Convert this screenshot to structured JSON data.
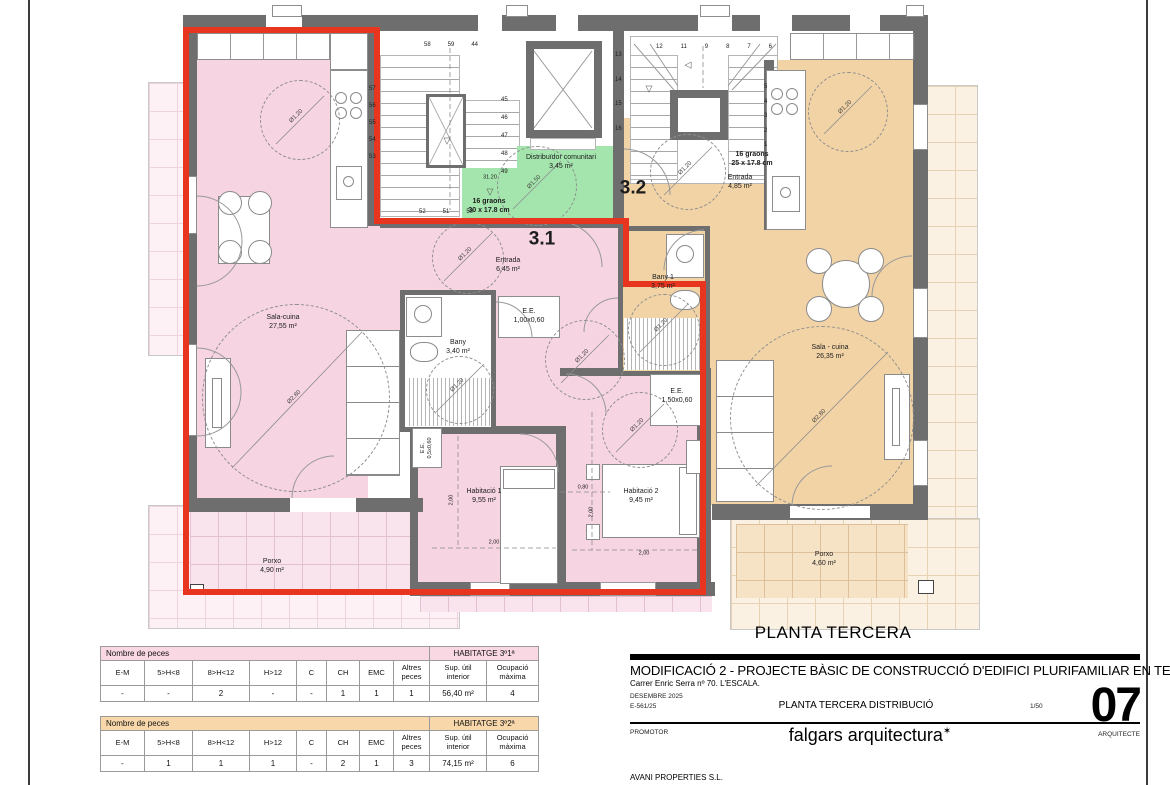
{
  "plan": {
    "heading": "PLANTA TERCERA",
    "unit31": "3.1",
    "unit32": "3.2",
    "icons": {
      "level_marker_down": "▽",
      "level_marker_left": "◁"
    },
    "labels": {
      "sala31": "Sala-cuina\n27,55 m²",
      "entrada31": "Entrada\n6,45 m²",
      "bany31": "Bany\n3,40 m²",
      "ee100": "E.E.\n1,00x0,60",
      "ee050": "E.E.\n0,5x0,60",
      "ee150": "E.E.\n1,50x0,60",
      "hab1": "Habitació 1\n9,55 m²",
      "hab2": "Habitació 2\n9,45 m²",
      "porxo31": "Porxo\n4,90 m²",
      "distribuidor": "Distribuïdor comunitari\n3,45 m²",
      "graons_left": "16 graons\n30 x 17.8 cm",
      "level": "31.20",
      "entrada32": "Entrada\n4,85 m²",
      "graons_right": "16 graons\n25 x 17.8 cm",
      "bany32": "Bany 1\n3,75 m²",
      "sala32": "Sala - cuina\n26,35 m²",
      "porxo32": "Porxo\n4,60 m²"
    },
    "dims": {
      "d120": "Ø1.20",
      "d150": "Ø1.50",
      "d280": "Ø2.80",
      "len200": "2,00",
      "len080": "0,80"
    },
    "stairs_left": {
      "top": [
        "58",
        "59",
        "44"
      ],
      "left_col": [
        "57",
        "56",
        "55",
        "54",
        "53"
      ],
      "right_col": [
        "45",
        "46",
        "47",
        "48",
        "49"
      ],
      "bottom": [
        "52",
        "51",
        "50"
      ]
    },
    "stairs_right": {
      "top": [
        "12",
        "11",
        "9",
        "8",
        "7",
        "6"
      ],
      "left_col": [
        "13",
        "14",
        "15",
        "16"
      ],
      "right_col": [
        "5",
        "4",
        "3",
        "2",
        "1"
      ]
    }
  },
  "tables": [
    {
      "section_label": "Nombre de peces",
      "habitatge_label": "HABITATGE 3º1ª",
      "columns": [
        "E-M",
        "5>H<8",
        "8>H<12",
        "H>12",
        "C",
        "CH",
        "EMC",
        "Altres\npeces",
        "Sup. útil\ninterior",
        "Ocupació\nmàxima"
      ],
      "values": [
        "-",
        "-",
        "2",
        "-",
        "-",
        "1",
        "1",
        "1",
        "56,40 m²",
        "4"
      ]
    },
    {
      "section_label": "Nombre de peces",
      "habitatge_label": "HABITATGE 3º2ª",
      "columns": [
        "E-M",
        "5>H<8",
        "8>H<12",
        "H>12",
        "C",
        "CH",
        "EMC",
        "Altres\npeces",
        "Sup. útil\ninterior",
        "Ocupació\nmàxima"
      ],
      "values": [
        "-",
        "1",
        "1",
        "1",
        "-",
        "2",
        "1",
        "3",
        "74,15 m²",
        "6"
      ]
    }
  ],
  "titleblock": {
    "project_title": "MODIFICACIÓ 2 - PROJECTE BÀSIC DE CONSTRUCCIÓ D'EDIFICI PLURIFAMILIAR EN TESTERA",
    "address": "Carrer Enric Serra nº 70. L'ESCALA.",
    "date_ref": "DESEMBRE 2025\nE-561/25",
    "sheet_title": "PLANTA TERCERA DISTRIBUCIÓ",
    "scale": "1/50",
    "sheet_number": "07",
    "promotor_label": "PROMOTOR",
    "promotor_name": "AVANI PROPERTIES S.L.",
    "studio": "falgars arquitectura",
    "logo_mark": "✶",
    "arquitecte_label": "ARQUITECTE"
  },
  "colors": {
    "boundary_red": "#e8351f",
    "unit31_pink": "#f6d4e1",
    "unit32_orange": "#f2d3a6",
    "communal_green": "#a4e5ad",
    "wall_gray": "#6e6e6e",
    "table1_header": "#f9d7e3",
    "table2_header": "#f8d8ab"
  }
}
